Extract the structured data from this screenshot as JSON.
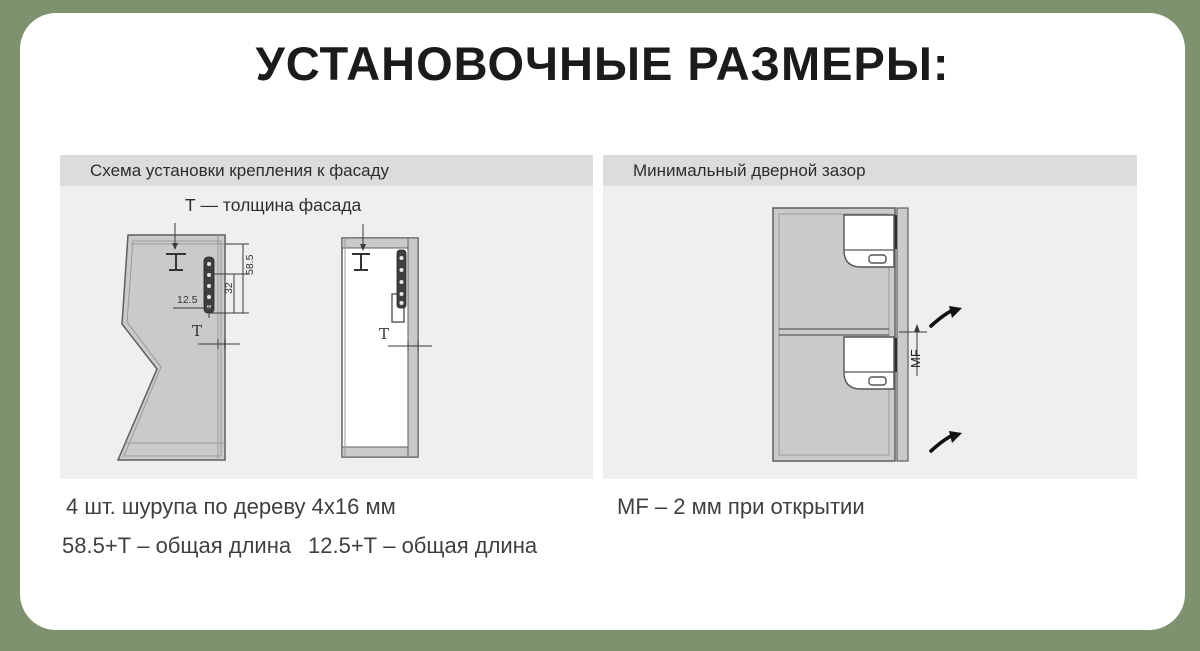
{
  "page": {
    "title": "УСТАНОВОЧНЫЕ РАЗМЕРЫ:"
  },
  "colors": {
    "background": "#7e9270",
    "card": "#ffffff",
    "panel_body": "#efefef",
    "panel_header": "#dcdcdc",
    "drawing_fill": "#cacaca",
    "drawing_outline": "#5f5f5f",
    "annotation": "#333333"
  },
  "left_panel": {
    "header": "Схема установки крепления к фасаду",
    "diagram_title": "Т — толщина фасада",
    "dimensions": {
      "length_total": "58.5",
      "length_inner": "32",
      "offset": "12.5",
      "thickness": "Т"
    },
    "captions": {
      "screws": "4 шт. шурупа по дереву 4x16 мм",
      "length_585": "58.5+Т – общая длина",
      "length_125": "12.5+Т – общая длина"
    }
  },
  "right_panel": {
    "header": "Минимальный дверной зазор",
    "gap_label": "MF",
    "caption": "MF – 2 мм при открытии"
  }
}
